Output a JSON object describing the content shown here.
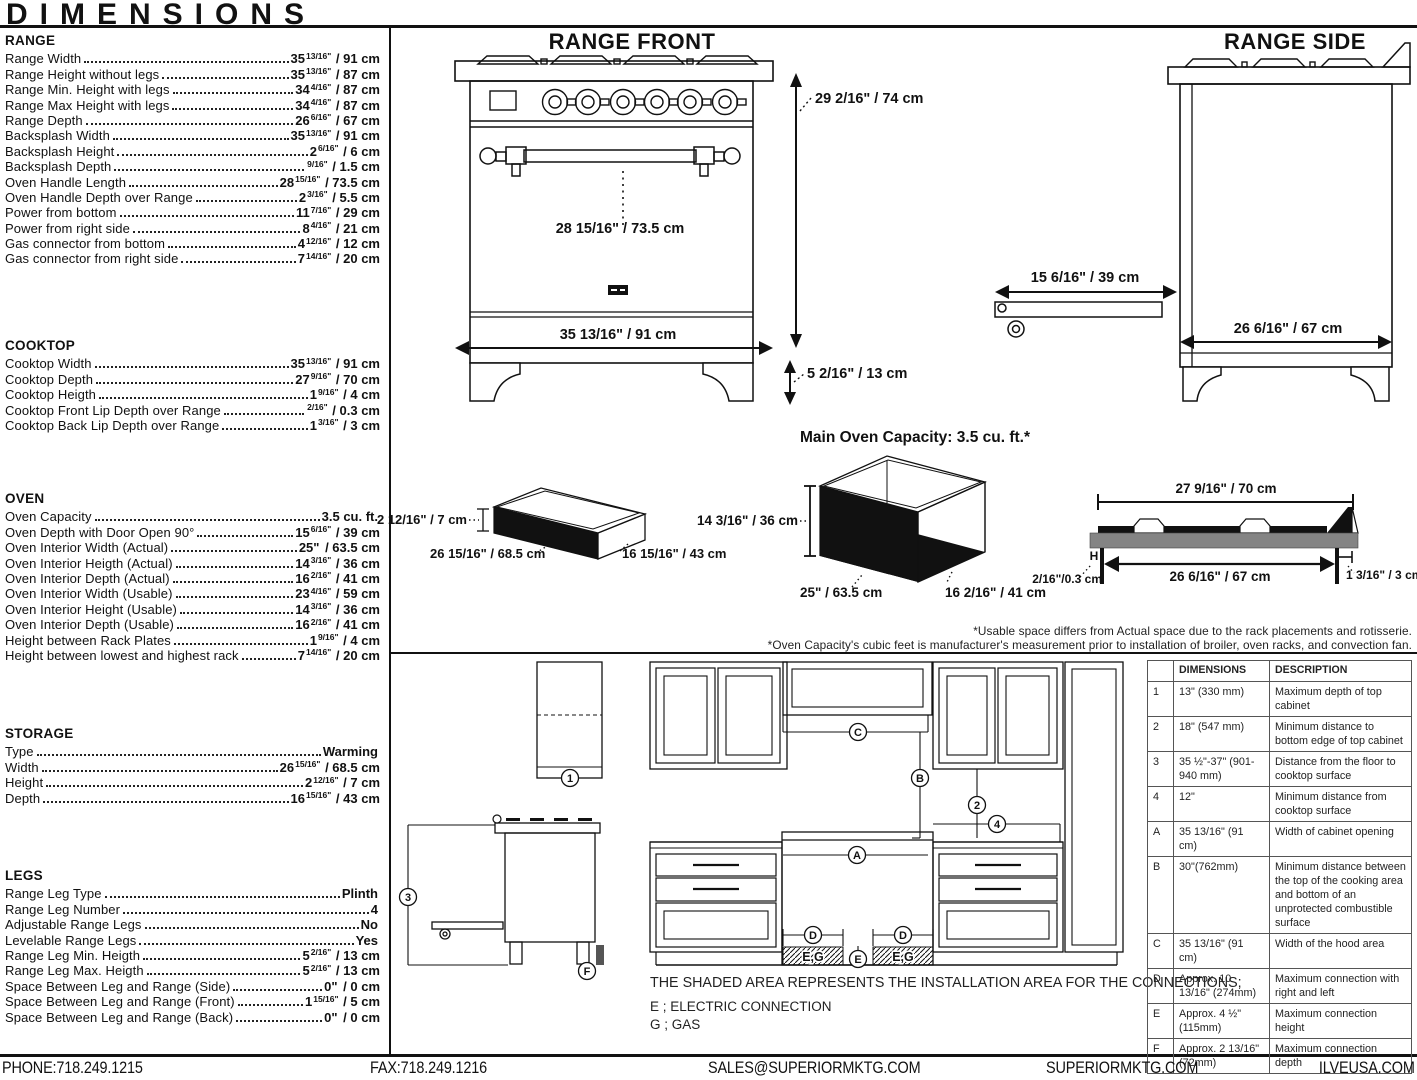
{
  "header": {
    "title": "DIMENSIONS"
  },
  "specs": {
    "range": {
      "title": "RANGE",
      "rows": [
        {
          "label": "Range Width",
          "main": "35",
          "sup": "13/16\"",
          "tail": " / 91 cm"
        },
        {
          "label": "Range Height without legs",
          "main": "35",
          "sup": "13/16\"",
          "tail": " / 87 cm"
        },
        {
          "label": "Range Min. Height with legs",
          "main": "34",
          "sup": "4/16\"",
          "tail": " / 87 cm"
        },
        {
          "label": "Range Max Height with legs",
          "main": "34",
          "sup": "4/16\"",
          "tail": " / 87 cm"
        },
        {
          "label": "Range Depth",
          "main": "26",
          "sup": "6/16\"",
          "tail": " / 67 cm"
        },
        {
          "label": "Backsplash Width",
          "main": "35",
          "sup": "13/16\"",
          "tail": " / 91 cm"
        },
        {
          "label": "Backsplash Height",
          "main": "2",
          "sup": "6/16\"",
          "tail": " / 6 cm"
        },
        {
          "label": "Backsplash Depth",
          "main": "",
          "sup": "9/16\"",
          "tail": " / 1.5 cm"
        },
        {
          "label": "Oven Handle Length",
          "main": "28",
          "sup": "15/16\"",
          "tail": " / 73.5 cm"
        },
        {
          "label": "Oven Handle Depth over Range",
          "main": "2",
          "sup": "3/16\"",
          "tail": " / 5.5 cm"
        },
        {
          "label": "Power from bottom",
          "main": "11",
          "sup": "7/16\"",
          "tail": " / 29 cm"
        },
        {
          "label": "Power from right side",
          "main": "8",
          "sup": "4/16\"",
          "tail": " / 21 cm"
        },
        {
          "label": "Gas connector from bottom",
          "main": "4",
          "sup": "12/16\"",
          "tail": " / 12 cm"
        },
        {
          "label": "Gas connector from right side",
          "main": "7",
          "sup": "14/16\"",
          "tail": " / 20 cm"
        }
      ]
    },
    "cooktop": {
      "title": "COOKTOP",
      "rows": [
        {
          "label": "Cooktop Width",
          "main": "35",
          "sup": "13/16\"",
          "tail": " / 91 cm"
        },
        {
          "label": "Cooktop Depth",
          "main": "27",
          "sup": "9/16\"",
          "tail": " / 70 cm"
        },
        {
          "label": "Cooktop Heigth",
          "main": "1",
          "sup": "9/16\"",
          "tail": " / 4 cm"
        },
        {
          "label": "Cooktop Front Lip Depth over Range",
          "main": "",
          "sup": "2/16\"",
          "tail": " / 0.3 cm"
        },
        {
          "label": "Cooktop Back Lip Depth over Range",
          "main": "1",
          "sup": "3/16\"",
          "tail": " / 3 cm"
        }
      ]
    },
    "oven": {
      "title": "OVEN",
      "rows": [
        {
          "label": "Oven Capacity",
          "main": "3.5 cu. ft.",
          "sup": "",
          "tail": ""
        },
        {
          "label": "Oven Depth with Door Open 90°",
          "main": "15",
          "sup": "6/16\"",
          "tail": " / 39 cm"
        },
        {
          "label": "Oven Interior Width (Actual)",
          "main": "25\"",
          "sup": "",
          "tail": " / 63.5 cm"
        },
        {
          "label": "Oven Interior Heigth (Actual)",
          "main": "14",
          "sup": "3/16\"",
          "tail": " / 36 cm"
        },
        {
          "label": "Oven Interior Depth (Actual)",
          "main": "16",
          "sup": "2/16\"",
          "tail": " / 41 cm"
        },
        {
          "label": "Oven Interior Width (Usable)",
          "main": "23",
          "sup": "4/16\"",
          "tail": " / 59 cm"
        },
        {
          "label": "Oven Interior Height (Usable)",
          "main": "14",
          "sup": "3/16\"",
          "tail": " / 36 cm"
        },
        {
          "label": "Oven Interior Depth (Usable)",
          "main": "16",
          "sup": "2/16\"",
          "tail": " / 41 cm"
        },
        {
          "label": "Height between Rack Plates",
          "main": "1",
          "sup": "9/16\"",
          "tail": " / 4 cm"
        },
        {
          "label": "Height between lowest and highest rack",
          "main": "7",
          "sup": "14/16\"",
          "tail": " / 20 cm"
        }
      ]
    },
    "storage": {
      "title": "STORAGE",
      "rows": [
        {
          "label": "Type",
          "main": "Warming",
          "sup": "",
          "tail": ""
        },
        {
          "label": "Width",
          "main": "26",
          "sup": "15/16\"",
          "tail": " / 68.5 cm"
        },
        {
          "label": "Height",
          "main": "2",
          "sup": "12/16\"",
          "tail": " / 7 cm"
        },
        {
          "label": "Depth",
          "main": "16",
          "sup": "15/16\"",
          "tail": " / 43 cm"
        }
      ]
    },
    "legs": {
      "title": "LEGS",
      "rows": [
        {
          "label": "Range Leg Type",
          "main": "Plinth",
          "sup": "",
          "tail": ""
        },
        {
          "label": "Range Leg Number",
          "main": "4",
          "sup": "",
          "tail": ""
        },
        {
          "label": "Adjustable Range Legs",
          "main": "No",
          "sup": "",
          "tail": ""
        },
        {
          "label": "Levelable Range Legs",
          "main": "Yes",
          "sup": "",
          "tail": ""
        },
        {
          "label": "Range Leg Min. Heigth",
          "main": "5",
          "sup": "2/16\"",
          "tail": " / 13 cm"
        },
        {
          "label": "Range Leg Max. Heigth",
          "main": "5",
          "sup": "2/16\"",
          "tail": " / 13 cm"
        },
        {
          "label": "Space Between Leg and Range (Side)",
          "main": "0\"",
          "sup": "",
          "tail": " / 0 cm"
        },
        {
          "label": "Space Between Leg and Range (Front)",
          "main": "1",
          "sup": "15/16\"",
          "tail": " / 5 cm"
        },
        {
          "label": "Space Between Leg and Range (Back)",
          "main": "0\"",
          "sup": "",
          "tail": " / 0 cm"
        }
      ]
    }
  },
  "diagrams": {
    "range_front": {
      "title": "RANGE FRONT",
      "height_label": "29 2/16\" / 74 cm",
      "handle_label": "28 15/16\" / 73.5 cm",
      "width_label": "35 13/16\" / 91 cm",
      "leg_label": "5 2/16\" / 13 cm"
    },
    "range_side": {
      "title": "RANGE SIDE",
      "door_label": "15 6/16\" / 39 cm",
      "depth_label": "26 6/16\" / 67 cm"
    },
    "storage_drawer": {
      "height_label": "2 12/16\" / 7 cm",
      "width_label": "26 15/16\" / 68.5 cm",
      "depth_label": "16 15/16\" / 43 cm"
    },
    "oven_box": {
      "title": "Main Oven Capacity: 3.5 cu. ft.*",
      "height_label": "14 3/16\" / 36 cm",
      "width_label": "25\" / 63.5 cm",
      "depth_label": "16 2/16\" / 41 cm"
    },
    "cooktop_profile": {
      "top_label": "27 9/16\" / 70 cm",
      "inner_label": "26 6/16\" / 67 cm",
      "h_label": "H",
      "left_label": "2/16\"/0.3 cm",
      "right_label": "1 3/16\" / 3 cm"
    },
    "footnote_line1": "*Usable space differs from Actual space due to the rack placements and rotisserie.",
    "footnote_line2": "*Oven Capacity's cubic feet is manufacturer's measurement prior to installation of broiler, oven racks, and convection fan."
  },
  "installation": {
    "markers": {
      "m1": "1",
      "m2": "2",
      "m3": "3",
      "m4": "4",
      "mA": "A",
      "mB": "B",
      "mC": "C",
      "mD": "D",
      "mE": "E",
      "mF": "F",
      "shaded": "E,G"
    },
    "note": "THE SHADED AREA REPRESENTS THE INSTALLATION AREA FOR THE CONNECTIONS;",
    "legend": [
      "E ; ELECTRIC CONNECTION",
      "G ; GAS"
    ]
  },
  "table": {
    "headers": [
      "",
      "DIMENSIONS",
      "DESCRIPTION"
    ],
    "rows": [
      {
        "id": "1",
        "dim": "13\" (330 mm)",
        "desc": "Maximum depth of top cabinet"
      },
      {
        "id": "2",
        "dim": "18\" (547 mm)",
        "desc": "Minimum distance to bottom edge of top cabinet"
      },
      {
        "id": "3",
        "dim": "35 ½\"-37\" (901-940 mm)",
        "desc": "Distance from the floor to cooktop surface"
      },
      {
        "id": "4",
        "dim": "12\"",
        "desc": "Minimum distance from cooktop surface"
      },
      {
        "id": "A",
        "dim": "35 13/16\" (91 cm)",
        "desc": "Width of cabinet opening"
      },
      {
        "id": "B",
        "dim": "30\"(762mm)",
        "desc": "Minimum distance between the top of the cooking area and bottom of an unprotected combustible surface"
      },
      {
        "id": "C",
        "dim": "35 13/16\" (91 cm)",
        "desc": "Width of the hood area"
      },
      {
        "id": "D",
        "dim": "Approx. 10 13/16\" (274mm)",
        "desc": "Maximum connection with right and left"
      },
      {
        "id": "E",
        "dim": "Approx. 4 ½\" (115mm)",
        "desc": "Maximum connection height"
      },
      {
        "id": "F",
        "dim": "Approx. 2 13/16\" (72mm)",
        "desc": "Maximum connection depth"
      }
    ]
  },
  "footer": {
    "phone": "PHONE:718.249.1215",
    "fax": "FAX:718.249.1216",
    "email": "SALES@SUPERIORMKTG.COM",
    "site": "SUPERIORMKTG.COM",
    "site2": "ILVEUSA.COM"
  }
}
